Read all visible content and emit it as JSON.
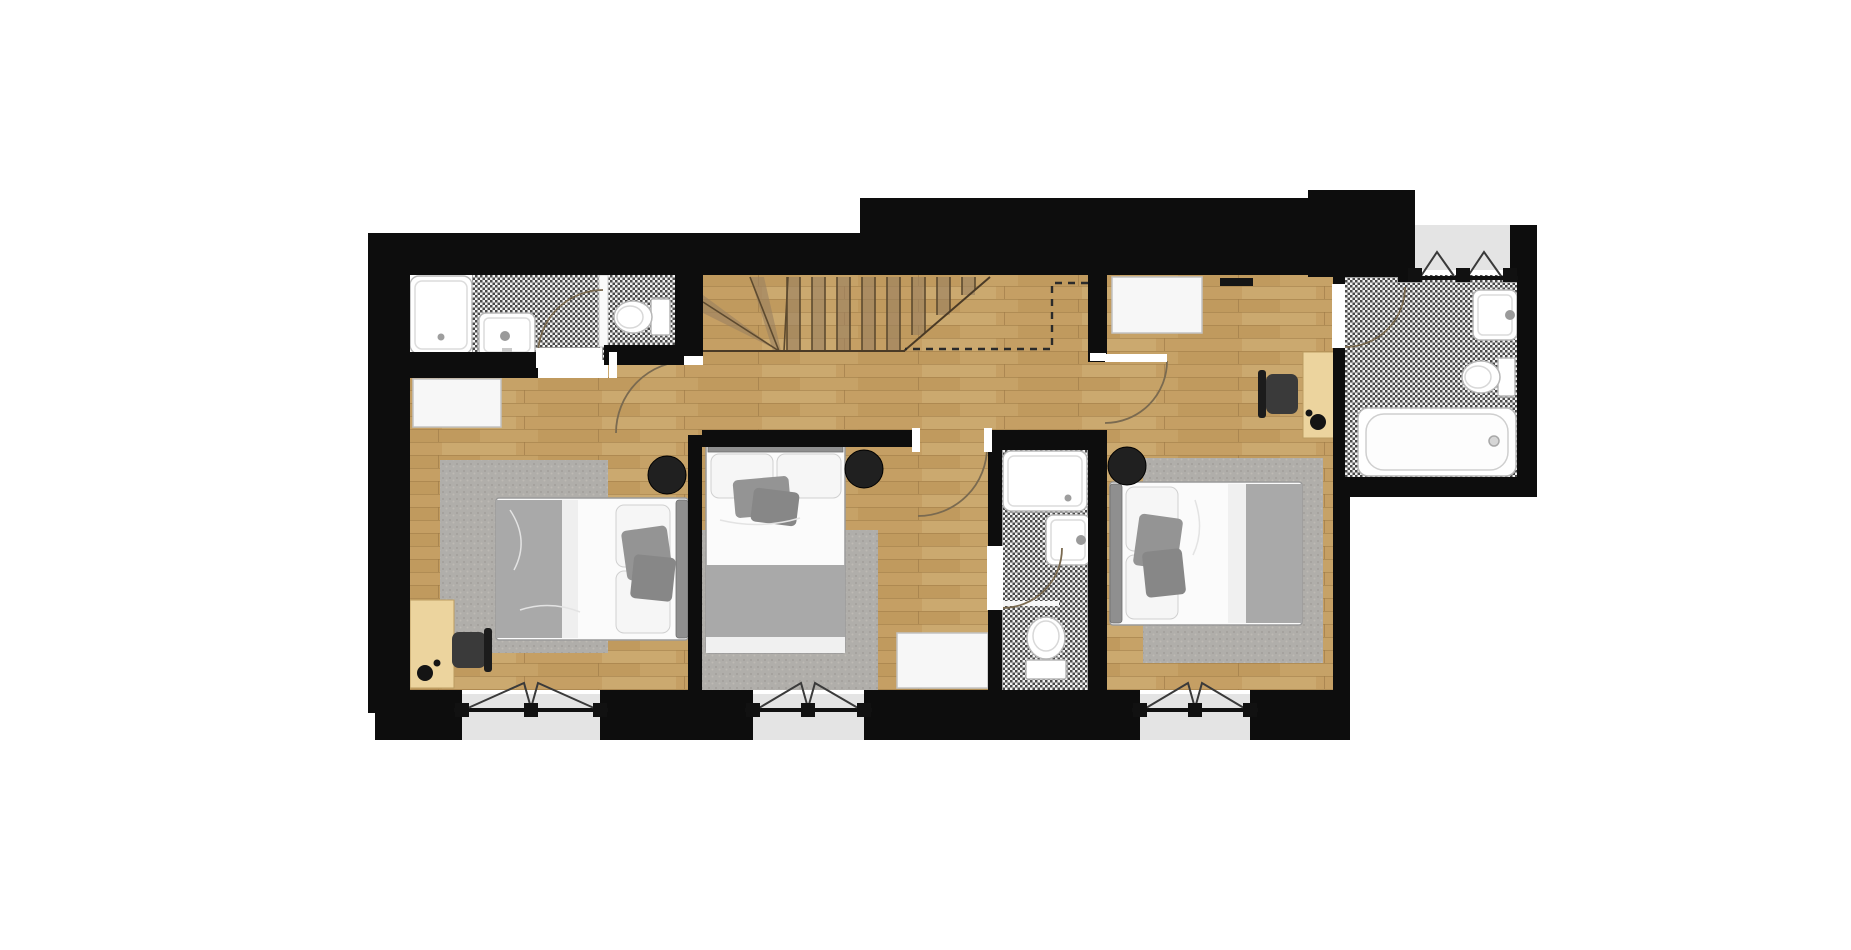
{
  "meta": {
    "label": "apartment upper-floor plan (top-down render)",
    "background": "#ffffff"
  },
  "colors": {
    "wall": "#0d0d0d",
    "outside_ground": "#e4e4e4",
    "door_arc": "#7a6a50",
    "side_table": "#202020",
    "rug": "#b0aeaa",
    "desk_wood": "#ecd49e",
    "chair": "#3a3a3a",
    "fixture_fill": "#ffffff",
    "fixture_stroke": "#b7b7b7",
    "bed_linen": "#fbfbfb",
    "bed_blanket": "#a9a9a9",
    "headboard": "#8f8f8f",
    "threshold": "#ffffff"
  },
  "rooms": [
    {
      "id": "bedroom-left",
      "label": "left bedroom",
      "floor": "wood planks",
      "contents": [
        "double bed",
        "area rug",
        "round side table",
        "dresser",
        "desk",
        "office chair",
        "desk lamp"
      ]
    },
    {
      "id": "bedroom-middle",
      "label": "middle bedroom",
      "floor": "wood planks",
      "contents": [
        "double bed",
        "area rug",
        "round side table",
        "dresser"
      ]
    },
    {
      "id": "bedroom-right",
      "label": "right bedroom",
      "floor": "wood planks",
      "contents": [
        "double bed",
        "area rug",
        "round side table",
        "dresser",
        "desk",
        "office chair",
        "desk lamp",
        "wall rail"
      ]
    },
    {
      "id": "bathroom-top-left",
      "label": "shower room top-left",
      "floor": "checker tile",
      "contents": [
        "shower tray",
        "washbasin",
        "toilet",
        "glass partition"
      ]
    },
    {
      "id": "shower-room-middle",
      "label": "middle shower room",
      "floor": "checker tile",
      "contents": [
        "shower tray",
        "washbasin",
        "toilet"
      ]
    },
    {
      "id": "bathroom-ensuite",
      "label": "en-suite bathroom",
      "floor": "checker tile",
      "contents": [
        "bathtub",
        "washbasin",
        "toilet"
      ]
    },
    {
      "id": "hallway",
      "label": "landing hallway",
      "floor": "wood planks",
      "contents": []
    },
    {
      "id": "staircase",
      "label": "staircase with winders",
      "floor": "wood treads",
      "contents": [
        "straight treads",
        "winder treads",
        "dashed void outline"
      ]
    }
  ],
  "openings": {
    "doors": 6,
    "bottom_windows": 3,
    "bay_casements_top_right": 2,
    "door_swing_arcs": 6
  }
}
